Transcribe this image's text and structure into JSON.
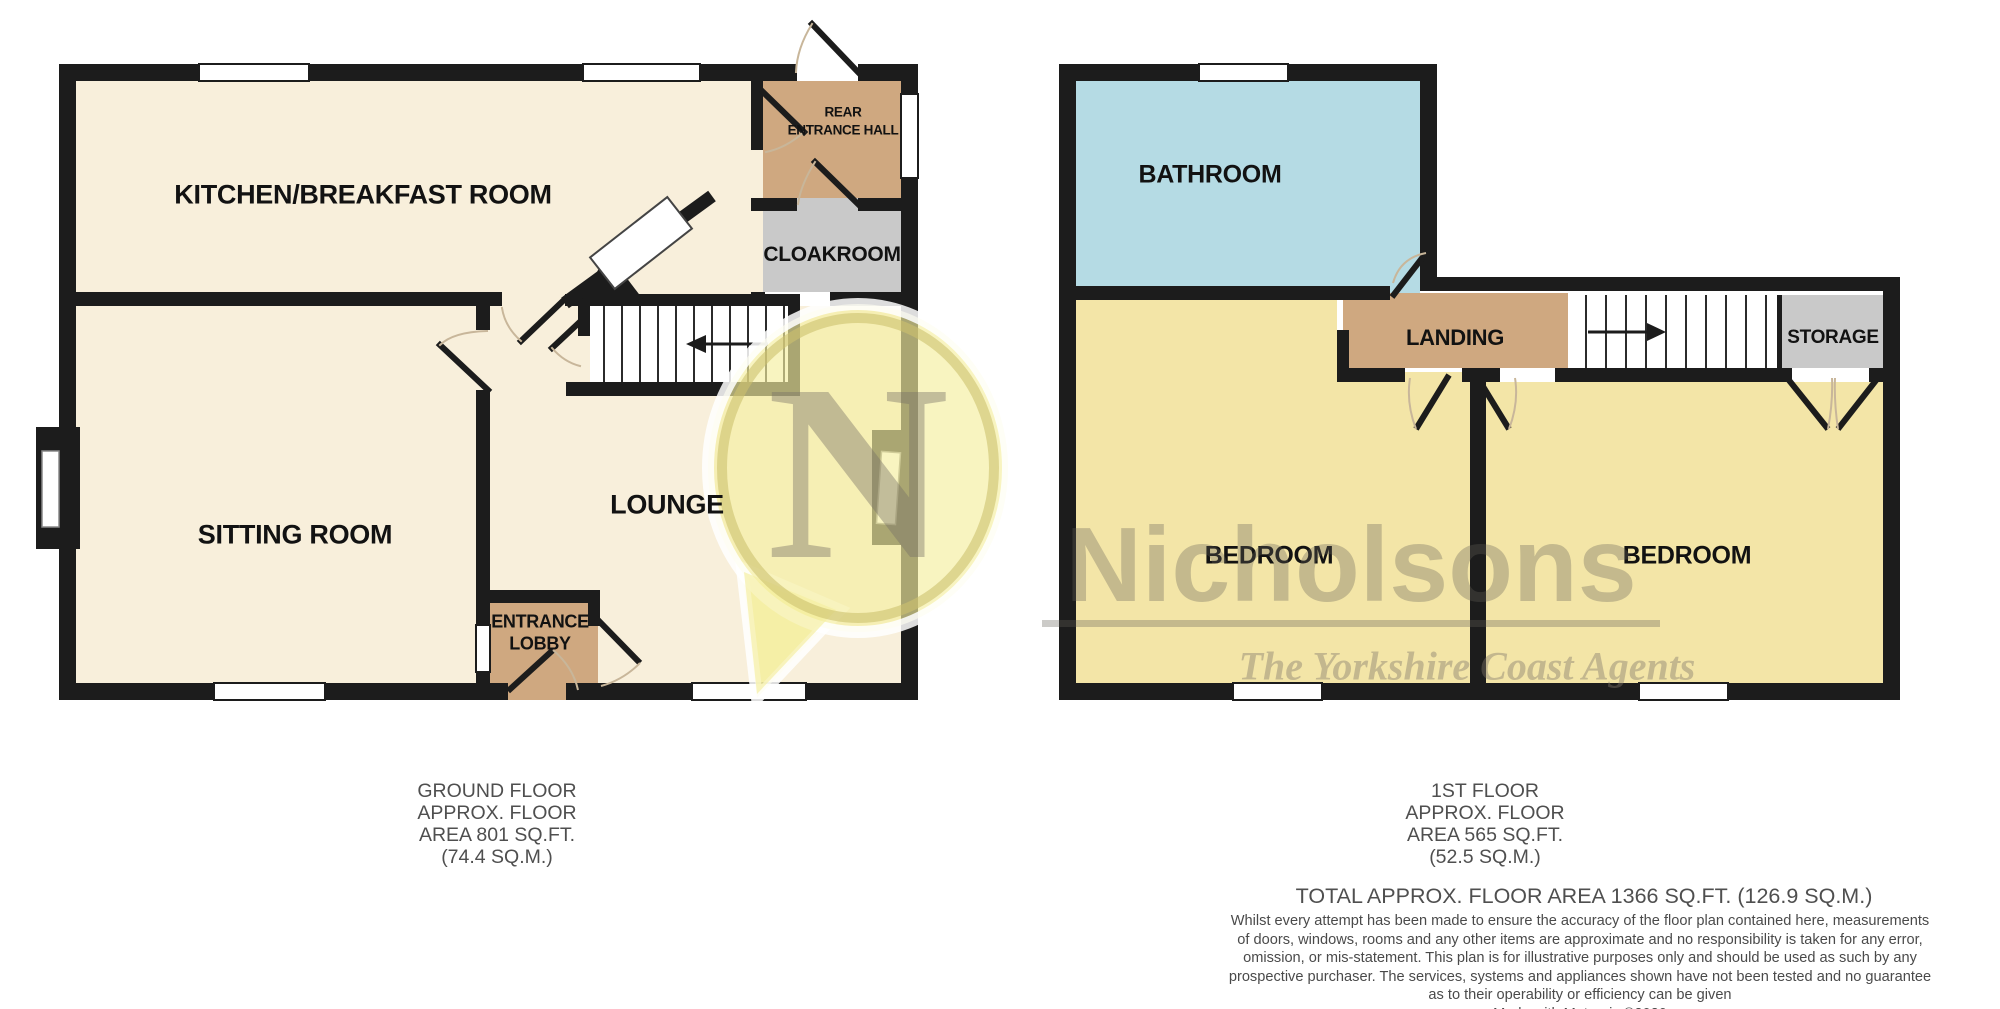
{
  "colors": {
    "wall": "#1c1c1c",
    "cream": "#f8efdb",
    "tan": "#cfa880",
    "grayroom": "#c9c9c9",
    "blue": "#b5dbe4",
    "yellow": "#f3e5a7",
    "stairs-white": "#ffffff",
    "tread": "#2b2b2b",
    "arc": "#c8b69a",
    "pin-fill": "rgba(244,238,160,0.66)",
    "pin-ring": "rgba(205,193,110,0.6)",
    "pin-halo": "rgba(255,255,255,0.85)",
    "pin-n": "rgba(118,112,102,0.42)"
  },
  "ground_floor": {
    "rooms": {
      "kitchen": "KITCHEN/BREAKFAST ROOM",
      "sitting": "SITTING ROOM",
      "lounge": "LOUNGE",
      "rear_hall_line1": "REAR",
      "rear_hall_line2": "ENTRANCE HALL",
      "cloakroom": "CLOAKROOM",
      "lobby_line1": "ENTRANCE",
      "lobby_line2": "LOBBY"
    },
    "caption": [
      "GROUND FLOOR",
      "APPROX. FLOOR",
      "AREA 801 SQ.FT.",
      "(74.4 SQ.M.)"
    ]
  },
  "first_floor": {
    "rooms": {
      "bathroom": "BATHROOM",
      "landing": "LANDING",
      "storage": "STORAGE",
      "bedroom_left": "BEDROOM",
      "bedroom_right": "BEDROOM"
    },
    "caption": [
      "1ST FLOOR",
      "APPROX. FLOOR",
      "AREA 565 SQ.FT.",
      "(52.5 SQ.M.)"
    ]
  },
  "summary": {
    "total": "TOTAL APPROX. FLOOR AREA 1366 SQ.FT. (126.9 SQ.M.)",
    "disclaimer": [
      "Whilst every attempt has been made to ensure the accuracy of the floor plan contained here, measurements",
      "of doors, windows, rooms and any other items are approximate and no responsibility is taken for any error,",
      "omission, or mis-statement. This plan is for illustrative purposes only and should be used as such by any",
      "prospective purchaser. The services, systems and appliances shown have not been tested and no guarantee",
      "as to their operability or efficiency can be given"
    ],
    "credit": "Made with Metropix ©2020"
  },
  "watermark": {
    "brand": "Nicholsons",
    "tagline": "The Yorkshire Coast Agents",
    "monogram": "N"
  }
}
